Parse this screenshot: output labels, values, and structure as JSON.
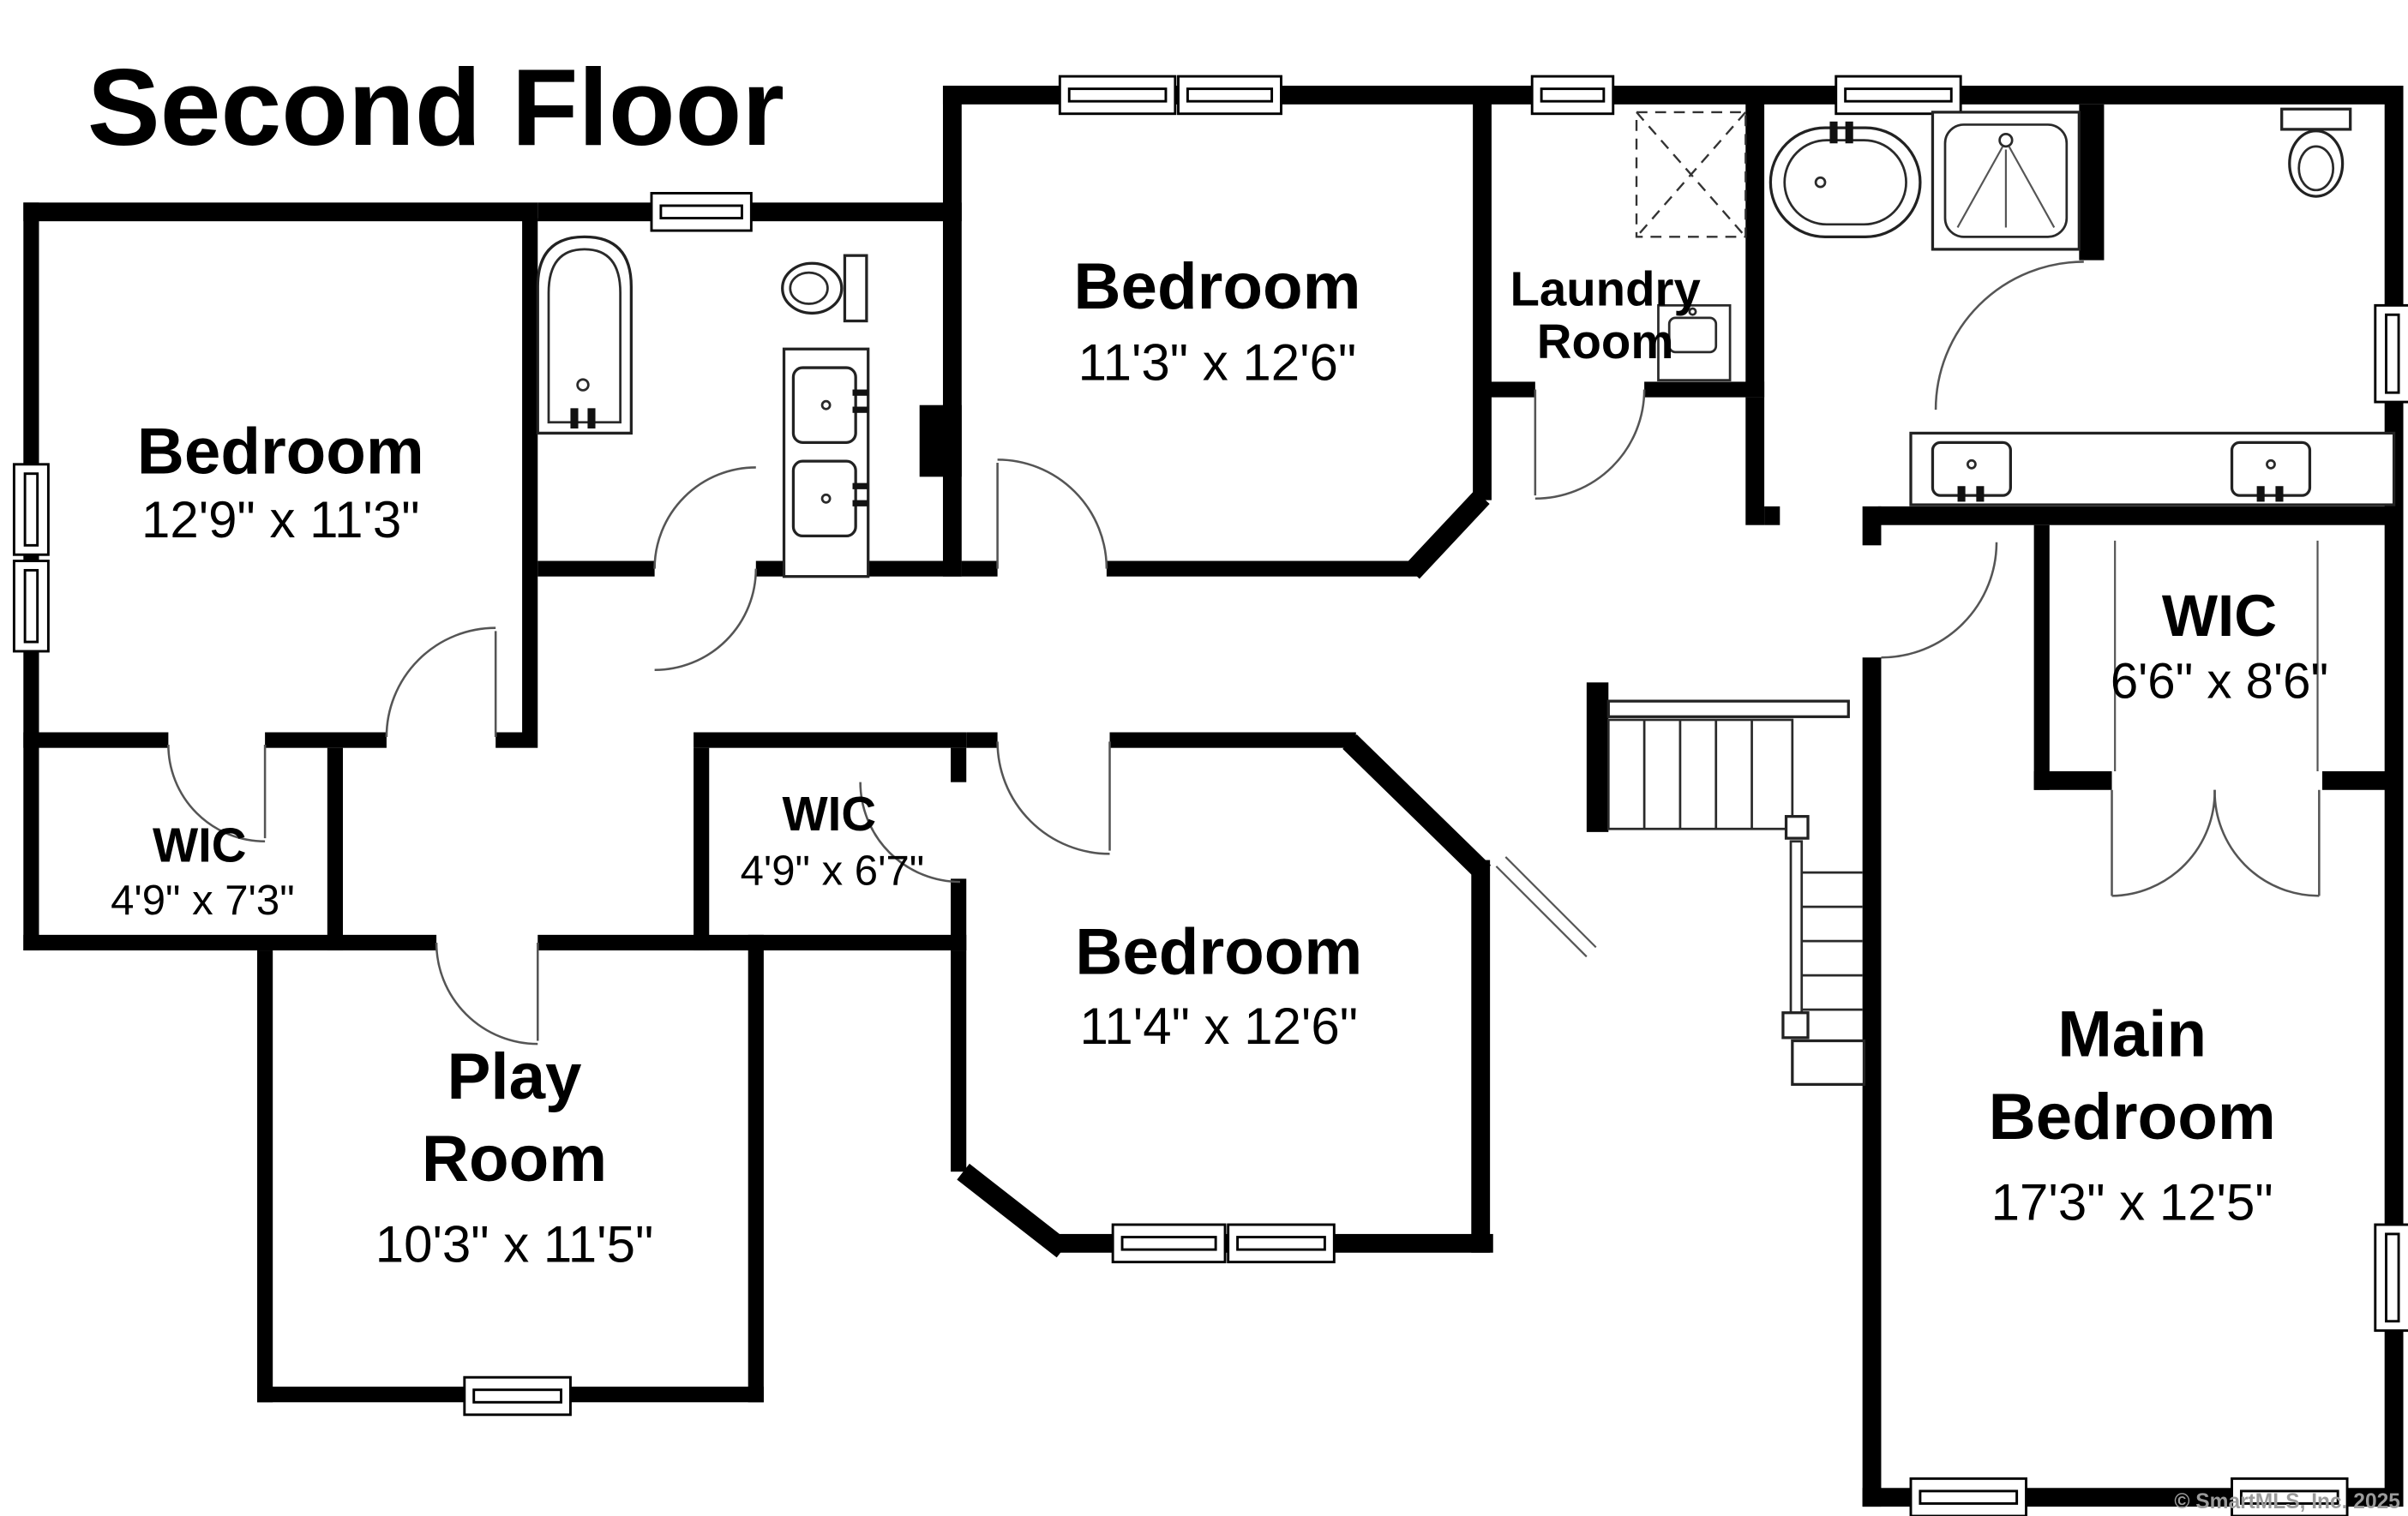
{
  "title": "Second Floor",
  "watermark": "© SmartMLS, Inc.  2025",
  "colors": {
    "walls": "#000000",
    "background": "#ffffff",
    "door_arc": "#555555",
    "watermark_text": "#9b9b9b"
  },
  "rooms": {
    "bedroom_left": {
      "name": "Bedroom",
      "dims": "12'9\" x 11'3\""
    },
    "bedroom_top": {
      "name": "Bedroom",
      "dims": "11'3\" x 12'6\""
    },
    "bedroom_mid": {
      "name": "Bedroom",
      "dims": "11'4\" x 12'6\""
    },
    "main_bedroom": {
      "name_line1": "Main",
      "name_line2": "Bedroom",
      "dims": "17'3\" x 12'5\""
    },
    "play_room": {
      "name_line1": "Play",
      "name_line2": "Room",
      "dims": "10'3\" x 11'5\""
    },
    "laundry": {
      "name_line1": "Laundry",
      "name_line2": "Room"
    },
    "wic_main": {
      "name": "WIC",
      "dims": "6'6\" x 8'6\""
    },
    "wic_left": {
      "name": "WIC",
      "dims": "4'9\" x 7'3\""
    },
    "wic_mid": {
      "name": "WIC",
      "dims": "4'9\" x 6'7\""
    }
  }
}
